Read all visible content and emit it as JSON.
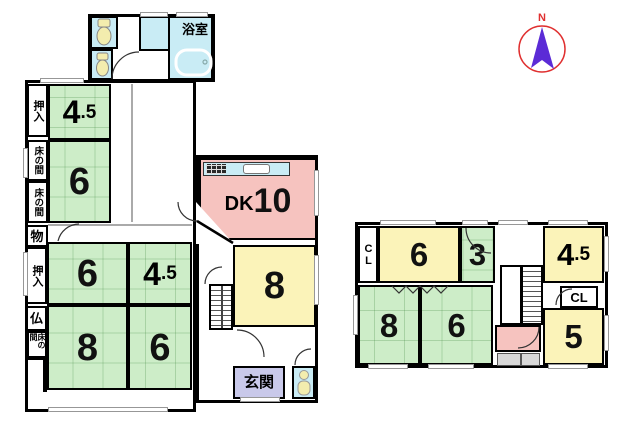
{
  "compass": {
    "north_label": "N"
  },
  "colors": {
    "tatami_green": "#cdedc8",
    "room_yellow": "#fbf3b9",
    "dk_pink": "#f6c3bf",
    "water_cyan": "#c9ecf5",
    "genkan_purple": "#c9c9ea",
    "storage_gray": "#d8d8d8",
    "compass_red": "#e03030",
    "compass_purple": "#5b2bd6",
    "fixture_yellow": "#f3edae"
  },
  "floor1": {
    "bath": "浴室",
    "oshiire_top": "押入",
    "tokonoma_a": "床の間",
    "tokonoma_b": "床の間",
    "storage": "物",
    "oshiire_mid": "押入",
    "altar": "仏",
    "tokonoma_small": "床の間",
    "room_45_top": {
      "big": "4",
      "small": ".5"
    },
    "room_6_top": "6",
    "room_6_mid": "6",
    "room_45_mid": {
      "big": "4",
      "small": ".5"
    },
    "room_8_left": "8",
    "room_6_bottom": "6",
    "dk": {
      "prefix": "DK",
      "big": "10"
    },
    "room_8_right": "8",
    "entrance": "玄関"
  },
  "floor2": {
    "closet_left": "CL",
    "room_6_top": "6",
    "room_3": "3",
    "room_45": {
      "big": "4",
      "small": ".5"
    },
    "closet_right": "CL",
    "room_5": "5",
    "room_8": "8",
    "room_6_bottom": "6"
  }
}
